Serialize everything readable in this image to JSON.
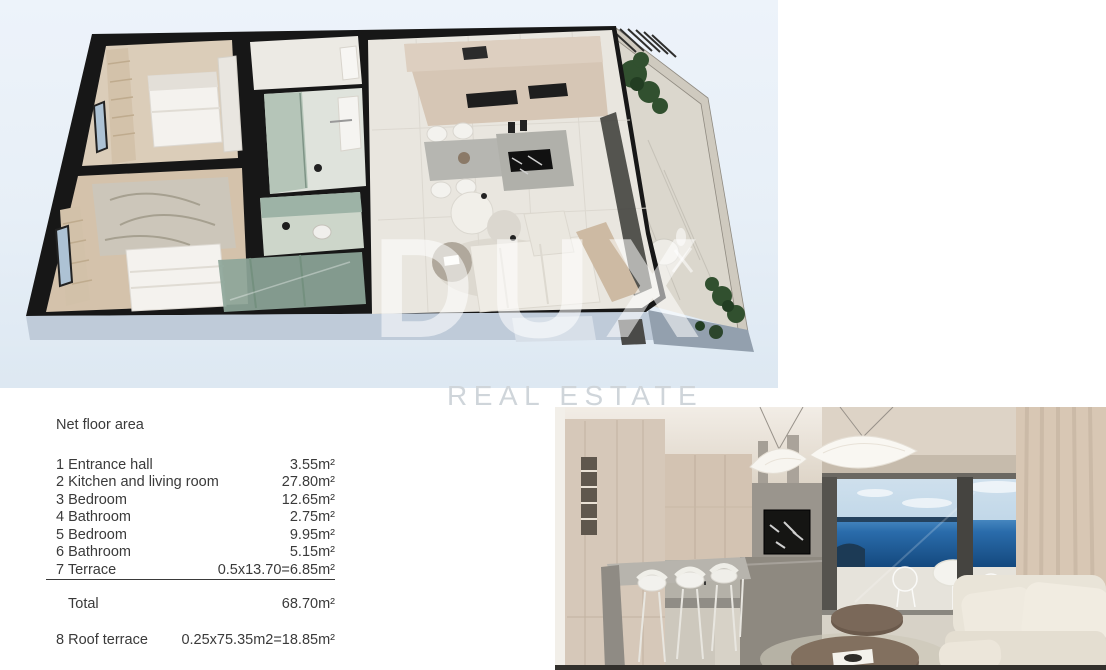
{
  "watermark": {
    "brand": "DUX",
    "subtitle": "REAL ESTATE"
  },
  "table": {
    "title": "Net floor area",
    "rows": [
      {
        "label": "1 Entrance hall",
        "value": "3.55m²"
      },
      {
        "label": "2 Kitchen and living room",
        "value": "27.80m²"
      },
      {
        "label": "3 Bedroom",
        "value": "12.65m²"
      },
      {
        "label": "4 Bathroom",
        "value": "2.75m²"
      },
      {
        "label": "5 Bedroom",
        "value": "9.95m²"
      },
      {
        "label": "6 Bathroom",
        "value": "5.15m²"
      },
      {
        "label": "7 Terrace",
        "value": "0.5x13.70=6.85m²",
        "underline": true
      }
    ],
    "total": {
      "label": "Total",
      "value": "68.70m²"
    },
    "footer": {
      "label": "8 Roof terrace",
      "value": "0.25x75.35m2=18.85m²"
    }
  },
  "colors": {
    "plan_background": "#e8f0f8",
    "wall_black": "#171717",
    "sea_blue": "#1c5d9c",
    "text_grey": "#3a3a3a",
    "watermark_grey": "#cfd5da"
  }
}
